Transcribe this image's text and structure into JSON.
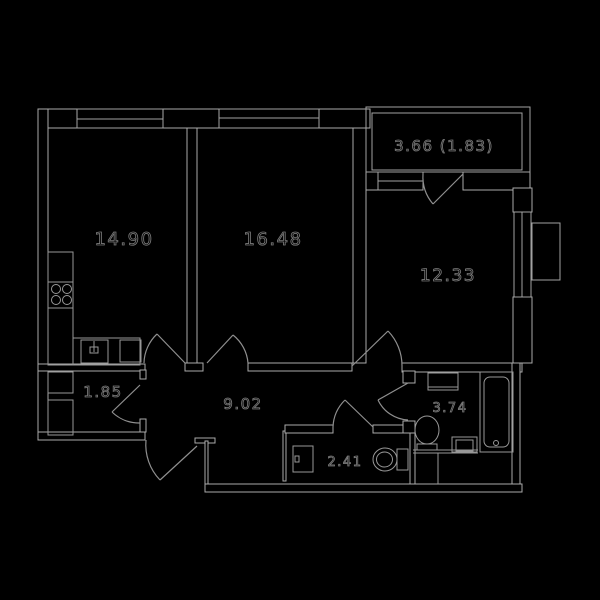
{
  "floor_plan": {
    "title": "two-room-apartment-floor-plan",
    "colors": {
      "background": "#000000",
      "wall_line": "#aaaaaa",
      "fixture_line": "#989898",
      "label_fill": "#000000",
      "label_outline": "#7a7a7a"
    },
    "rooms": [
      {
        "name": "kitchen-living-room",
        "area_label": "14.90"
      },
      {
        "name": "bedroom",
        "area_label": "16.48"
      },
      {
        "name": "bedroom-2",
        "area_label": "12.33"
      },
      {
        "name": "balcony",
        "area_label": "3.66 (1.83)"
      },
      {
        "name": "storage",
        "area_label": "1.85"
      },
      {
        "name": "hallway",
        "area_label": "9.02"
      },
      {
        "name": "wc",
        "area_label": "2.41"
      },
      {
        "name": "bathroom",
        "area_label": "3.74"
      }
    ],
    "fixtures": [
      "stove-icon",
      "kitchen-sink-icon",
      "wardrobe-icon",
      "washing-machine-icon",
      "toilet-icon",
      "wash-basin-icon",
      "bathtub-icon",
      "cabinet-icon"
    ]
  }
}
